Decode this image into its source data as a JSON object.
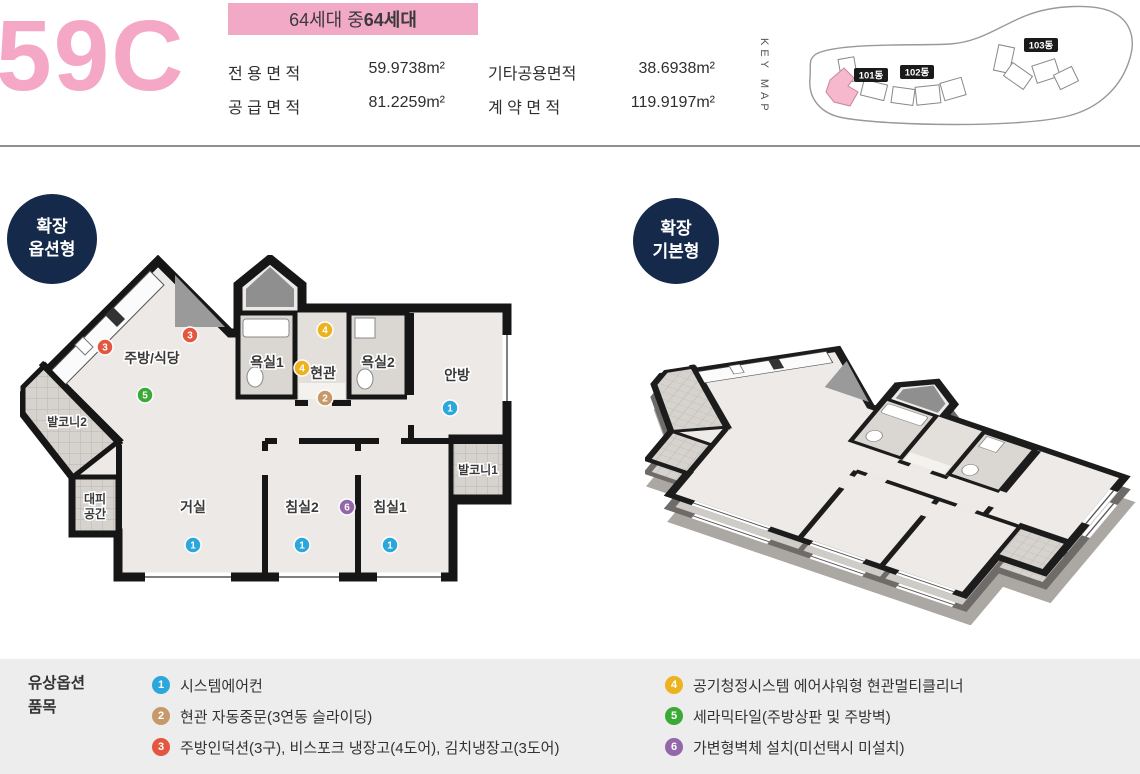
{
  "header": {
    "unit_code": "59C",
    "badge": {
      "normal": "64세대 중 ",
      "bold": "64세대"
    },
    "areas": [
      {
        "label": "전 용 면 적",
        "value": "59.9738m²"
      },
      {
        "label": "공 급 면 적",
        "value": "81.2259m²"
      },
      {
        "label": "기타공용면적",
        "value": "38.6938m²"
      },
      {
        "label": "계 약 면 적",
        "value": "119.9197m²"
      }
    ],
    "keymap": {
      "label": "KEY MAP",
      "buildings": [
        {
          "name": "101동"
        },
        {
          "name": "102동"
        },
        {
          "name": "103동"
        }
      ],
      "highlighted": "101동"
    }
  },
  "plan": {
    "left_badge": {
      "line1": "확장",
      "line2": "옵션형"
    },
    "right_badge": {
      "line1": "확장",
      "line2": "기본형"
    },
    "rooms": {
      "kitchen": "주방/식당",
      "bath1": "욕실1",
      "entry": "현관",
      "bath2": "욕실2",
      "master": "안방",
      "balcony1": "발코니1",
      "balcony2": "발코니2",
      "refuge_line1": "대피",
      "refuge_line2": "공간",
      "living": "거실",
      "bed2": "침실2",
      "bed1": "침실1"
    }
  },
  "legend": {
    "title_line1": "유상옵션",
    "title_line2": "품목",
    "items": [
      {
        "num": "1",
        "color": "#2BA7DC",
        "text": "시스템에어컨"
      },
      {
        "num": "2",
        "color": "#C6996B",
        "text": "현관 자동중문(3연동 슬라이딩)"
      },
      {
        "num": "3",
        "color": "#E25740",
        "text": "주방인덕션(3구), 비스포크 냉장고(4도어), 김치냉장고(3도어)"
      },
      {
        "num": "4",
        "color": "#EDB21F",
        "text": "공기청정시스템 에어샤워형 현관멀티클리너"
      },
      {
        "num": "5",
        "color": "#3BA935",
        "text": "세라믹타일(주방상판 및 주방벽)"
      },
      {
        "num": "6",
        "color": "#9467A9",
        "text": "가변형벽체 설치(미선택시 미설치)"
      }
    ]
  },
  "colors": {
    "accent_pink": "#F5A8C6",
    "badge_pink_bg": "#F2A9C5",
    "navy": "#15294B",
    "keymap_highlight": "#F5B8CD"
  }
}
